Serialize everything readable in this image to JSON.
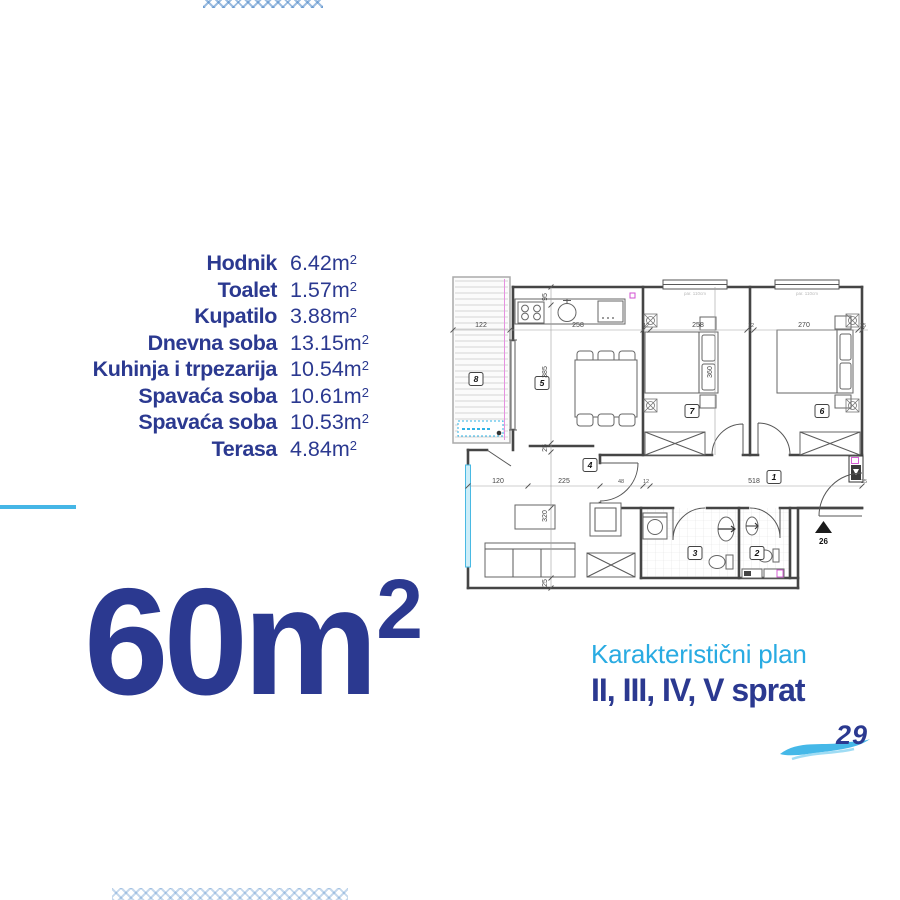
{
  "colors": {
    "navy": "#2b3990",
    "light_blue": "#29abe2",
    "divider_blue": "#45b6e6",
    "plan_line": "#454545",
    "window_cyan": "#49b9e3",
    "magenta": "#d24fd2"
  },
  "room_list": {
    "unit_base": "m",
    "unit_sup": "2",
    "rows": [
      {
        "label": "Hodnik",
        "value": "6.42"
      },
      {
        "label": "Toalet",
        "value": "1.57"
      },
      {
        "label": "Kupatilo",
        "value": "3.88"
      },
      {
        "label": "Dnevna soba",
        "value": "13.15"
      },
      {
        "label": "Kuhinja i trpezarija",
        "value": "10.54"
      },
      {
        "label": "Spavaća soba",
        "value": "10.61"
      },
      {
        "label": "Spavaća soba",
        "value": "10.53"
      },
      {
        "label": "Terasa",
        "value": "4.84"
      }
    ]
  },
  "total_area": {
    "number": "60",
    "unit_base": "m",
    "unit_sup": "2"
  },
  "caption": {
    "line1": "Karakteristični plan",
    "line2": "II, III, IV, V sprat"
  },
  "footer": {
    "page_number": "29"
  },
  "floor_plan": {
    "labels": [
      {
        "t": "122",
        "x": 34,
        "y": 55,
        "s": "dim"
      },
      {
        "t": "258",
        "x": 131,
        "y": 55,
        "s": "dim"
      },
      {
        "t": "12",
        "x": 199,
        "y": 55,
        "s": "dimsmall"
      },
      {
        "t": "258",
        "x": 251,
        "y": 55,
        "s": "dim"
      },
      {
        "t": "12",
        "x": 304,
        "y": 55,
        "s": "dimsmall"
      },
      {
        "t": "270",
        "x": 357,
        "y": 55,
        "s": "dim"
      },
      {
        "t": "25",
        "x": 416,
        "y": 55,
        "s": "dimsmall"
      },
      {
        "t": "120",
        "x": 51,
        "y": 211,
        "s": "dim"
      },
      {
        "t": "225",
        "x": 117,
        "y": 211,
        "s": "dim"
      },
      {
        "t": "48",
        "x": 174,
        "y": 211,
        "s": "dimsmall"
      },
      {
        "t": "12",
        "x": 199,
        "y": 211,
        "s": "dimsmall"
      },
      {
        "t": "518",
        "x": 307,
        "y": 211,
        "s": "dim"
      },
      {
        "t": "25",
        "x": 417,
        "y": 211,
        "s": "dimsmall"
      },
      {
        "t": "95",
        "x": 100,
        "y": 25,
        "s": "vdim"
      },
      {
        "t": "385",
        "x": 100,
        "y": 100,
        "s": "vdim"
      },
      {
        "t": "25",
        "x": 100,
        "y": 176,
        "s": "vdim"
      },
      {
        "t": "320",
        "x": 100,
        "y": 244,
        "s": "vdim"
      },
      {
        "t": "25",
        "x": 100,
        "y": 311,
        "s": "vdim"
      },
      {
        "t": "360",
        "x": 265,
        "y": 100,
        "s": "vdim"
      },
      {
        "t": "par. 110cm",
        "x": 248,
        "y": 23,
        "s": "win"
      },
      {
        "t": "par. 110cm",
        "x": 360,
        "y": 23,
        "s": "win"
      },
      {
        "t": "26",
        "x": 376.5,
        "y": 272,
        "s": "ent"
      }
    ],
    "room_markers": [
      {
        "n": "8",
        "x": 29,
        "y": 107
      },
      {
        "n": "5",
        "x": 95,
        "y": 111
      },
      {
        "n": "4",
        "x": 143,
        "y": 193
      },
      {
        "n": "7",
        "x": 245,
        "y": 139
      },
      {
        "n": "6",
        "x": 375,
        "y": 139
      },
      {
        "n": "1",
        "x": 327,
        "y": 205
      },
      {
        "n": "3",
        "x": 248,
        "y": 281
      },
      {
        "n": "2",
        "x": 310,
        "y": 281
      }
    ]
  }
}
